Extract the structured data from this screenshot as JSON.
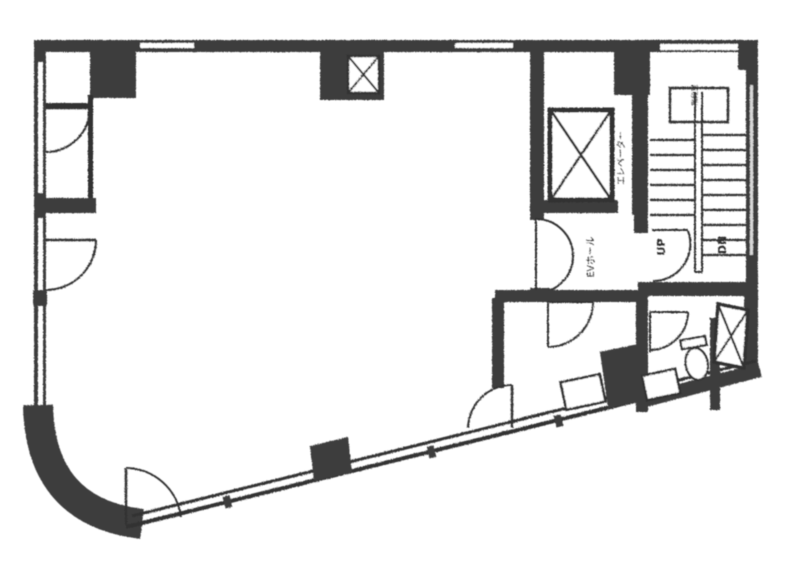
{
  "document": {
    "type": "scanned architectural floor plan (Japanese office building floor)",
    "style": "monochrome photocopy"
  },
  "labels": {
    "elevator": "エレベーター",
    "elevator_hall": "EVホール",
    "stairs_up": "UP",
    "stairs_down": "DN",
    "stairwell": "階段室"
  },
  "colors": {
    "wall": "#3d3d3d",
    "line": "#303030",
    "paper": "#ffffff"
  },
  "icons": {
    "elevator_shaft": "box with X cross",
    "pipe_shaft": "small box with X cross",
    "doors": "quarter-circle swing arcs",
    "stairs": "treads with center handrail, UP/DN"
  }
}
